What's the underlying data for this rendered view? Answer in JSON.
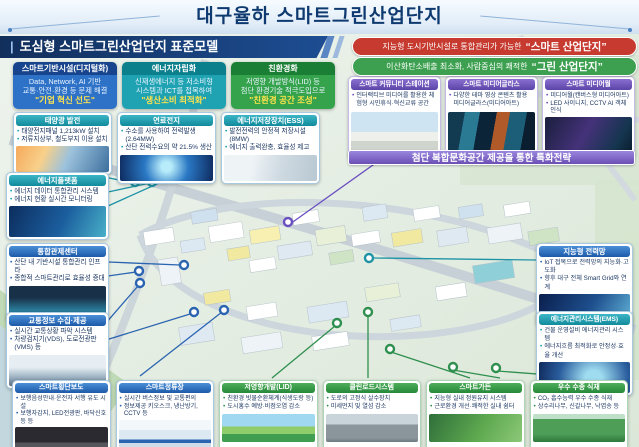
{
  "title": "대구율하 스마트그린산업단지",
  "ribbon": {
    "prefix": "|",
    "label": "도심형 스마트그린산업단지 표준모델"
  },
  "banners": [
    {
      "prefix": "지능형 도시기반시설로 통합관리가 가능한",
      "highlight": "“스마트 산업단지”",
      "color": "#c63a2f"
    },
    {
      "prefix": "이산화탄소배출 최소화, 사람중심의 쾌적한",
      "highlight": "“그린 산업단지”",
      "color": "#3da050"
    }
  ],
  "pillars": [
    {
      "title": "스마트기반시설(디지털화)",
      "line1": "Data, Network, AI 기반",
      "line2": "교통·안전·환경 등 문제 해결",
      "highlight": "\"기업 혁신 선도\"",
      "header_color": "#17448c",
      "body_color": "#2e72c8"
    },
    {
      "title": "에너지자립화",
      "line1": "신재생에너지 등 저소비형",
      "line2": "시스템과 ICT를 접목하여",
      "highlight": "\"생산소비 최적화\"",
      "header_color": "#0c7f8c",
      "body_color": "#1fa3b2"
    },
    {
      "title": "친환경화",
      "line1": "저영향 개발방식(LID) 등",
      "line2": "첨단 환경기술 적극도입으로",
      "highlight": "\"친환경 공간 조성\"",
      "header_color": "#1a7f34",
      "body_color": "#34a34b"
    }
  ],
  "energy_row": [
    {
      "title": "태양광 발전",
      "bullets": [
        "태양전지패널 1,213kW 설치",
        "저류지상부, 철도부지 이용 설치"
      ]
    },
    {
      "title": "연료전지",
      "bullets": [
        "수소를 사용하여 전력발생(2.64MW)",
        "산단 전력수요의 약 21.5% 생산"
      ]
    },
    {
      "title": "에너지저장장치(ESS)",
      "bullets": [
        "발전전력의 안정적 저장시설(8MW)",
        "에너지 출력완충, 효율성 제고"
      ]
    }
  ],
  "left_column": [
    {
      "title": "에너지플랫폼",
      "bullets": [
        "에너지 데이터 통합관리 시스템",
        "에너지 현황 실시간 모니터링"
      ]
    },
    {
      "title": "통합관제센터",
      "bullets": [
        "산단 내 기반시설 통합관리 인프라",
        "종합적 스마트관리로 효율성 증대"
      ]
    },
    {
      "title": "교통정보 수집·제공",
      "bullets": [
        "실시간 교통상황 파악 시스템",
        "차량검지기(VDS), 도로전광판(VMS) 등"
      ]
    }
  ],
  "purple_section": {
    "boxes": [
      {
        "title": "스마트 커뮤니티 스테이션",
        "bullets": [
          "인터랙티브 미디어를 활용한 체험형 시민휴식·혁신교류 공간"
        ]
      },
      {
        "title": "스마트 미디어글라스",
        "bullets": [
          "다양한 테마 영상 콘텐츠 활용 미디어글라스(미디어아트)"
        ]
      },
      {
        "title": "스마트 미디어월",
        "bullets": [
          "미디어월(캔버스형 미디어아트)",
          "LED 사이니지, CCTV AI 객체인식"
        ]
      }
    ],
    "banner": "첨단 복합문화공간 제공을 통한 특화전략"
  },
  "right_column": [
    {
      "title": "지능형 전력망",
      "bullets": [
        "IoT 접목으로 전력망의 지능화·고도화",
        "향후 대구 전체 Smart Grid와 연계"
      ]
    },
    {
      "title": "에너지관리시스템(EMS)",
      "bullets": [
        "건물 운영설비 에너지관리 시스템",
        "에너지흐름 최적화로 안정성·효율 개선"
      ]
    }
  ],
  "bottom_row": [
    {
      "title": "스마트횡단보도",
      "bullets": [
        "보행음성안내·운전자 서행 유도 시설",
        "보행자감지, LED전광판, 바닥신호등 등"
      ]
    },
    {
      "title": "스마트정류장",
      "bullets": [
        "실시간 버스정보 및 교통편의",
        "정보제공 키오스크, 냉난방기, CCTV 등"
      ]
    },
    {
      "title": "저영향개발(LID)",
      "bullets": [
        "친환경 빗물순환체계(식생도랑 등)",
        "도시홍수 예방·비점오염 감소"
      ]
    },
    {
      "title": "클린로드시스템",
      "bullets": [
        "도로의 고정식 살수장치",
        "미세먼지 및 열섬 감소"
      ]
    },
    {
      "title": "스마트가든",
      "bullets": [
        "지능형 실내 정원유지 시스템",
        "근로환경 개선·쾌적한 실내 쉼터"
      ]
    },
    {
      "title": "우수 수종 식재",
      "bullets": [
        "CO₂ 흡수능력 우수 수종 식재",
        "상수리나무, 신갈나무, 낙엽송 등"
      ]
    }
  ],
  "colors": {
    "teal": "#14a0b0",
    "blue": "#2a64b0",
    "green": "#2f8f4e",
    "purple": "#6a4fc0",
    "navy": "#122f5c",
    "highlight_yellow": "#ffe34d"
  }
}
